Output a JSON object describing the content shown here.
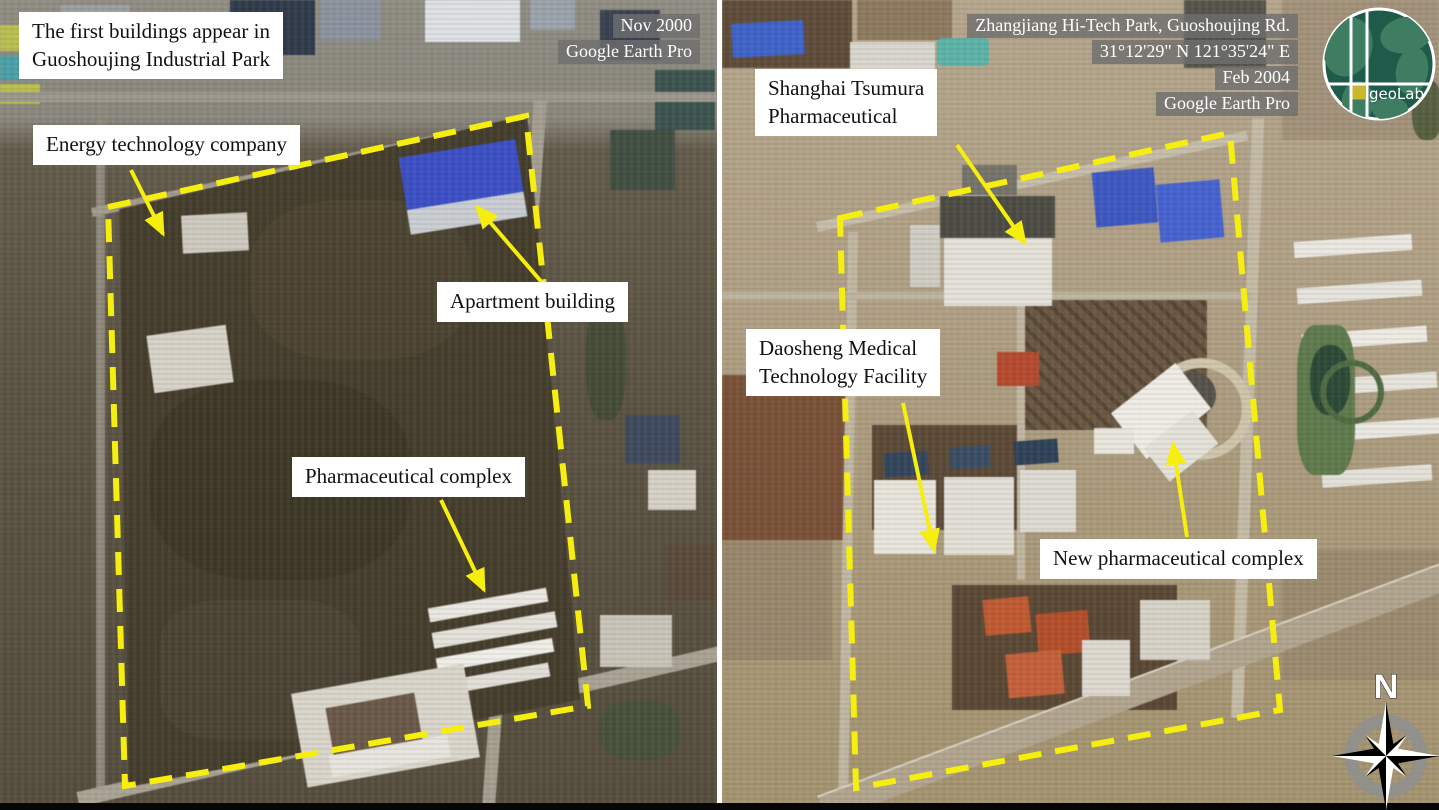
{
  "figure": {
    "left": {
      "credits": [
        "Nov 2000",
        "Google Earth Pro"
      ],
      "labels": {
        "intro": "The first buildings appear in\nGuoshoujing Industrial Park",
        "energy": "Energy technology company",
        "apartment": "Apartment building",
        "pharma": "Pharmaceutical complex"
      }
    },
    "right": {
      "credits": [
        "Zhangjiang Hi-Tech Park, Guoshoujing Rd.",
        "31°12'29\" N 121°35'24\" E",
        "Feb 2004",
        "Google Earth Pro"
      ],
      "labels": {
        "tsumura": "Shanghai Tsumura\nPharmaceutical",
        "daosheng": "Daosheng Medical\nTechnology Facility",
        "new_pharma": "New pharmaceutical complex"
      }
    },
    "logo_text": "geoLab",
    "compass_north": "N",
    "colors": {
      "annotation_line": "#f5ee0e",
      "label_box_bg": "#ffffff",
      "label_text": "#111111",
      "credit_text": "#ffffff",
      "credit_bg": "#6e6e6e",
      "logo_green": "#1f5b49",
      "logo_land": "#3f7d63",
      "logo_yellow": "#c9b82e"
    }
  }
}
